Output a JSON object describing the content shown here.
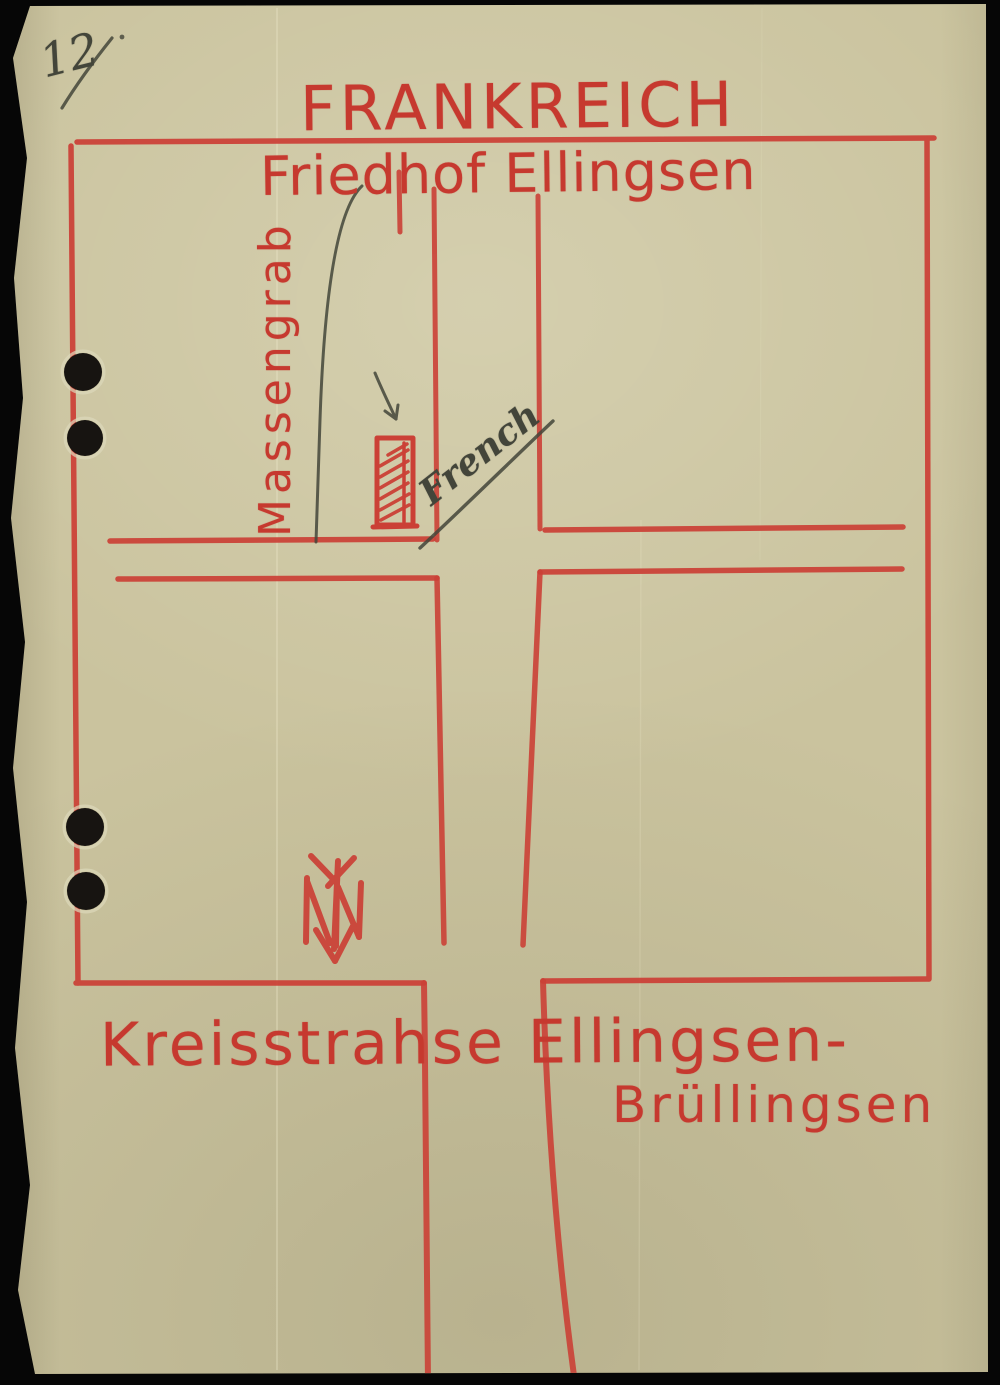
{
  "document": {
    "page_number_annotation": "12"
  },
  "map": {
    "title": "FRANKREICH",
    "subtitle": "Friedhof Ellingsen",
    "labels": {
      "mass_grave": "Massengrab",
      "french_annotation": "French",
      "road_name_line1": "Kreisstrahse Ellingsen-",
      "road_name_line2": "Brüllingsen"
    },
    "icons": {
      "north_arrow": "north-arrow-pointing-down-with-N",
      "mass_grave_marker": "red-hatched-rectangle",
      "leader_arrow": "pencil-arrow",
      "leader_line": "pencil-curved-line",
      "punch_holes": "four-black-punch-holes"
    }
  },
  "colors": {
    "paper": "#cac39e",
    "red_line": "#cb4036",
    "red_text": "#c6392f",
    "pencil": "#43453a",
    "scan_bg": "#060606"
  }
}
